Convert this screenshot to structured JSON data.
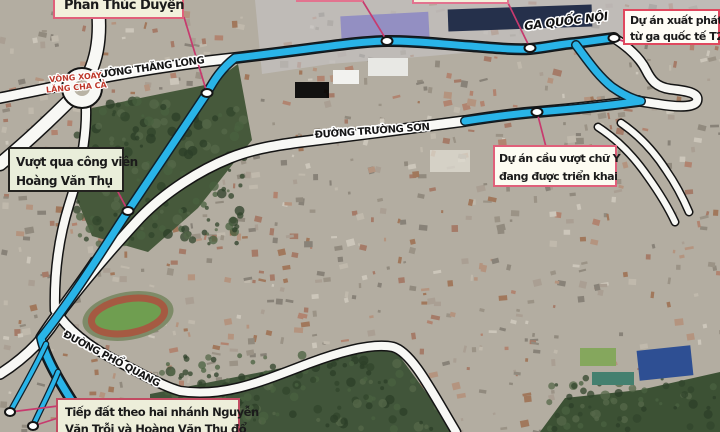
{
  "road_labels": {
    "thang_long": "ĐƯỜNG THĂNG LONG",
    "truong_son": "ĐƯỜNG TRƯỜNG SƠN",
    "pho_quang": "ĐƯỜNG PHỔ QUANG",
    "roundabout_line1": "VÒNG XOAY",
    "roundabout_line2": "LĂNG CHA CẢ",
    "station": "GA QUỐC NỘI"
  },
  "annotations": {
    "phan_thuc_duyen": "Phan Thúc Duyện",
    "park_crossing_line1": "Vượt qua công viên",
    "park_crossing_line2": "Hoàng Văn Thụ",
    "start_line1": "Dự án xuất phát",
    "start_line2": "từ ga quốc tế T2",
    "y_bridge_line1": "Dự án cầu vượt chữ Y",
    "y_bridge_line2": "đang được triển khai",
    "landing_line1": "Tiếp đất theo hai nhánh Nguyễn",
    "landing_line2": "Văn Trỗi và Hoàng Văn Thụ đổ"
  },
  "colors": {
    "route_line": "#29b4e8",
    "leader_line": "#c73a6e",
    "annotation_border": "#e0607a",
    "road_fill": "#f8f8f5",
    "roundabout_text": "#bf392c",
    "park_green": "#46593b"
  }
}
